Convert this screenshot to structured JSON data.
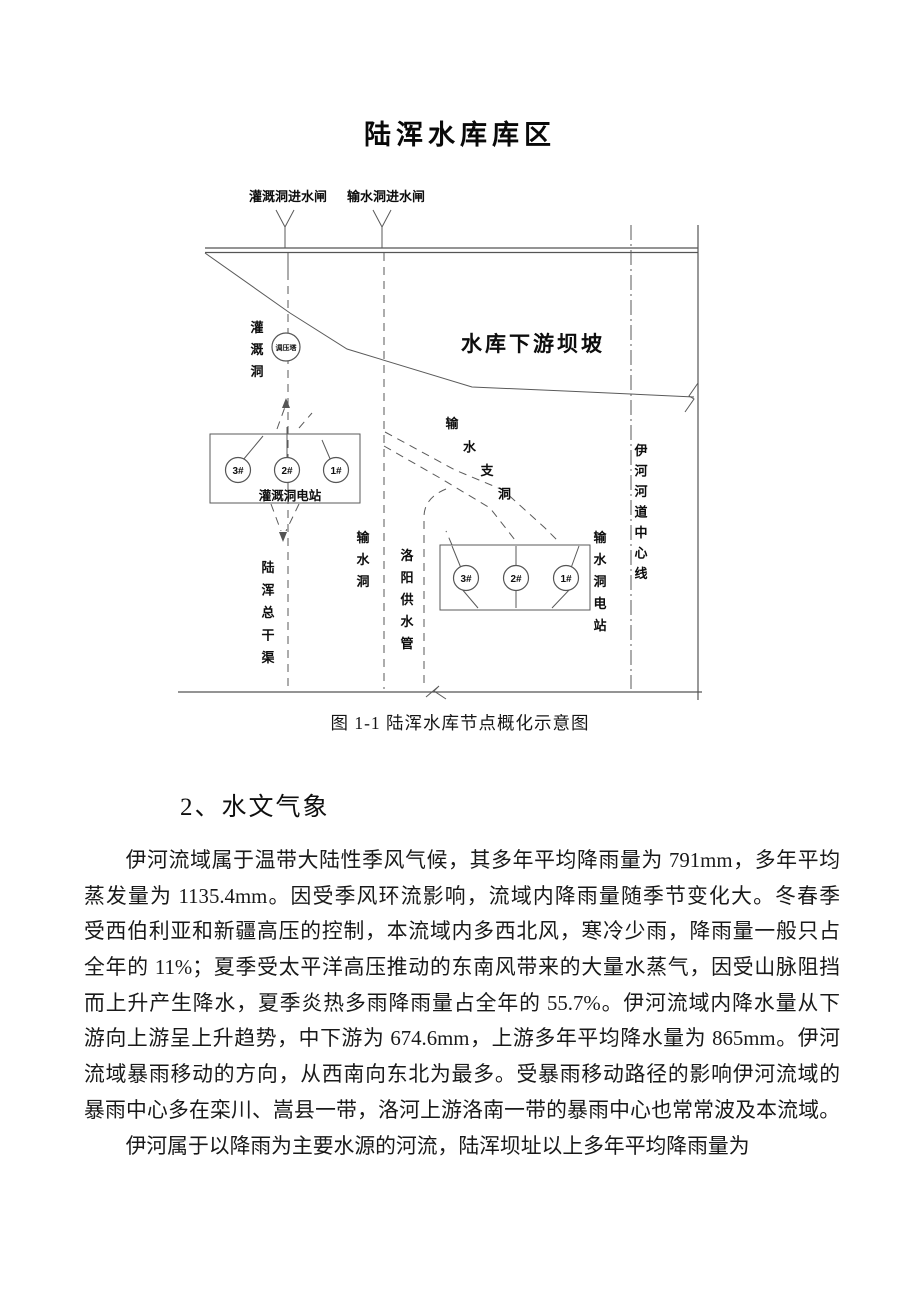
{
  "figure": {
    "title": "陆浑水库库区",
    "caption": "图 1-1  陆浑水库节点概化示意图",
    "labels": {
      "gate_left": "灌溉洞进水闸",
      "gate_right": "输水洞进水闸",
      "dam_slope": "水库下游坝坡",
      "irrigation_tunnel": "灌溉洞",
      "surge_tower": "调压塔",
      "irrigation_station": "灌溉洞电站",
      "main_canal": "陆浑总干渠",
      "conveyance_tunnel": "输水洞",
      "luoyang_pipe": "洛阳供水管",
      "branch_tunnel": "输水支洞",
      "conveyance_station": "输水洞电站",
      "river_centerline": "伊河河道中心线",
      "units_left": [
        "3#",
        "2#",
        "1#"
      ],
      "units_right": [
        "3#",
        "2#",
        "1#"
      ]
    }
  },
  "section": {
    "heading": "2、水文气象"
  },
  "body": {
    "para1_lines": [
      "伊河流域属于温带大陆性季风气候，其多年平均降雨量为 791mm，多年平均",
      "蒸发量为 1135.4mm。因受季风环流影响，流域内降雨量随季节变化大。冬春季",
      "受西伯利亚和新疆高压的控制，本流域内多西北风，寒冷少雨，降雨量一般只占",
      "全年的 11%；夏季受太平洋高压推动的东南风带来的大量水蒸气，因受山脉阻挡",
      "而上升产生降水，夏季炎热多雨降雨量占全年的 55.7%。伊河流域内降水量从下",
      "游向上游呈上升趋势，中下游为 674.6mm，上游多年平均降水量为 865mm。伊河",
      "流域暴雨移动的方向，从西南向东北为最多。受暴雨移动路径的影响伊河流域的",
      "暴雨中心多在栾川、嵩县一带，洛河上游洛南一带的暴雨中心也常常波及本流域。"
    ],
    "para2_lines": [
      "伊河属于以降雨为主要水源的河流，陆浑坝址以上多年平均降雨量为"
    ]
  }
}
